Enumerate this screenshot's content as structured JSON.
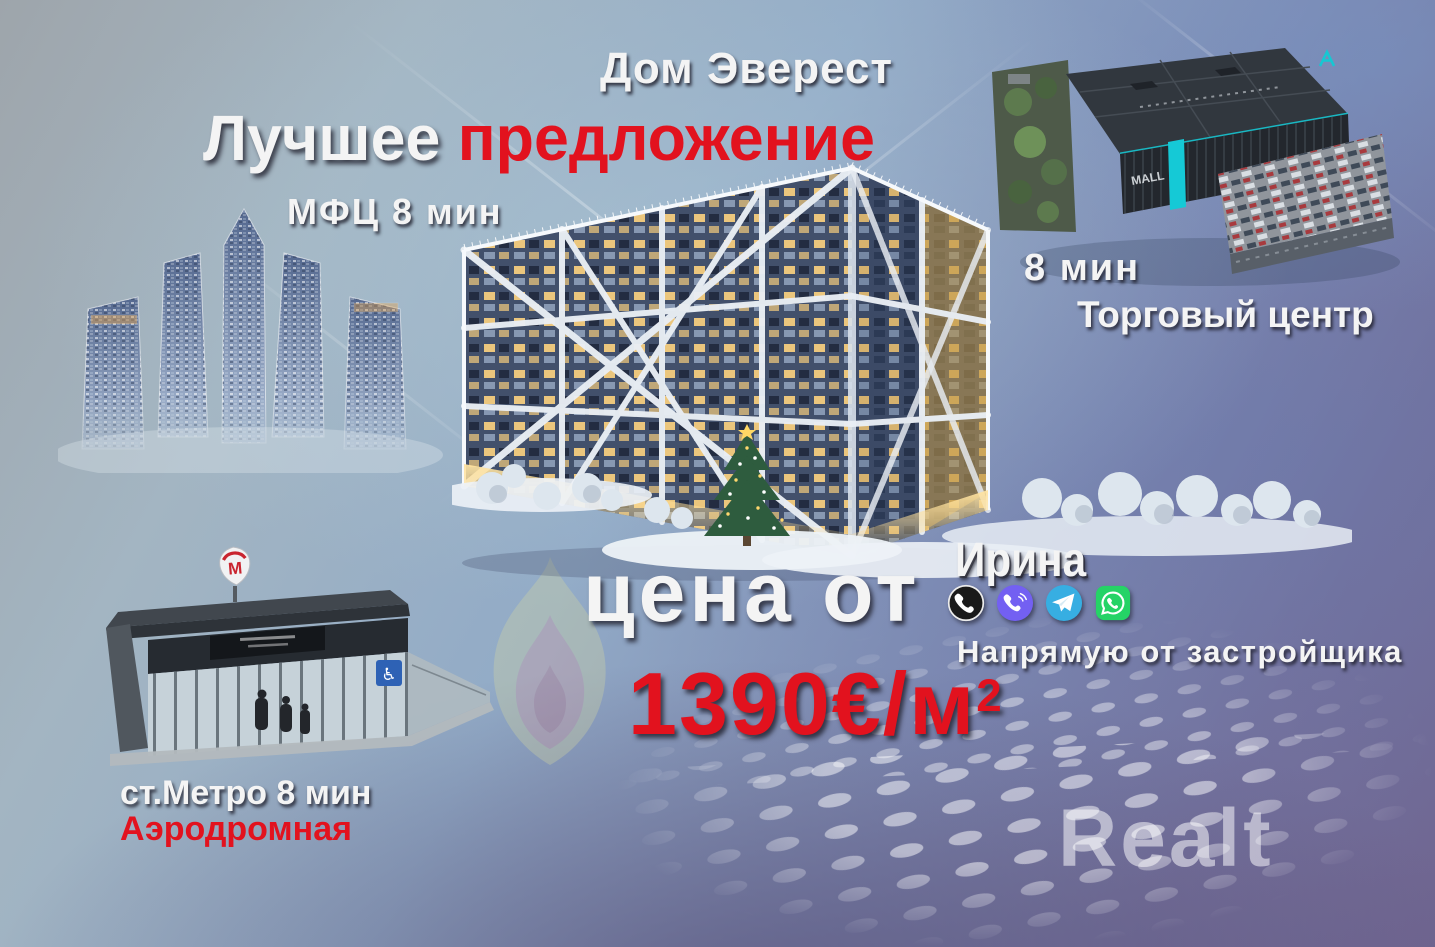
{
  "poster": {
    "project_title": "Дом Эверест",
    "headline": {
      "part_white": "Лучшее",
      "part_red": "предложение"
    },
    "poi_mfc": {
      "label": "МФЦ 8 мин"
    },
    "poi_mall": {
      "time": "8 мин",
      "name": "Торговый центр",
      "sign": "MALL",
      "logo": "A"
    },
    "poi_metro": {
      "label": "ст.Метро 8 мин",
      "station": "Аэродромная",
      "logo_letter": "М"
    },
    "price": {
      "label": "цена от",
      "amount": "1390€/м",
      "superscript": "2"
    },
    "contact": {
      "name": "Ирина",
      "note": "Напрямую от застройщика",
      "icons": [
        {
          "name": "phone-icon",
          "color": "#1a1a1a"
        },
        {
          "name": "viber-icon",
          "color": "#7360f2"
        },
        {
          "name": "telegram-icon",
          "color": "#37aee2"
        },
        {
          "name": "whatsapp-icon",
          "color": "#25d366"
        }
      ]
    },
    "watermark": "Realt",
    "colors": {
      "accent_red": "#e2121e",
      "text_white": "#f4f4f4",
      "mall_teal": "#17c7d2",
      "background_top": "#9ea5ab",
      "background_bottom": "#6f6590"
    }
  }
}
